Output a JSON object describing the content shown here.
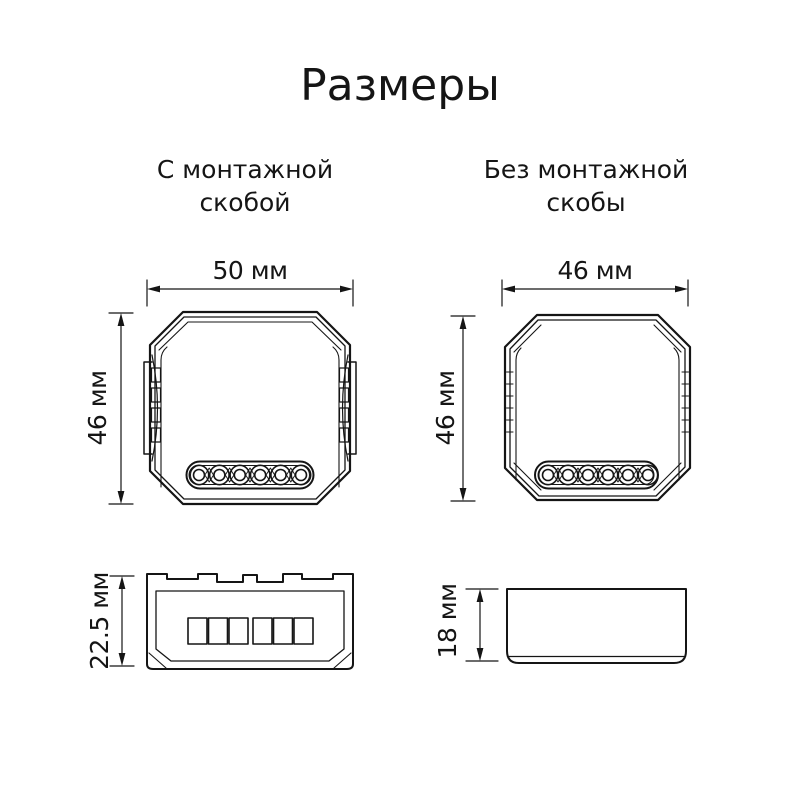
{
  "page": {
    "title": "Размеры"
  },
  "colors": {
    "background": "#ffffff",
    "ink": "#151515"
  },
  "columns": {
    "left": {
      "heading_line1": "С монтажной",
      "heading_line2": "скобой"
    },
    "right": {
      "heading_line1": "Без монтажной",
      "heading_line2": "скобы"
    }
  },
  "figures": {
    "left_top": {
      "width_label": "50 мм",
      "height_label": "46 мм",
      "terminal_count": 6
    },
    "right_top": {
      "width_label": "46 мм",
      "height_label": "46 мм",
      "terminal_count": 6
    },
    "left_side": {
      "height_label": "22.5 мм"
    },
    "right_side": {
      "height_label": "18 мм"
    }
  }
}
